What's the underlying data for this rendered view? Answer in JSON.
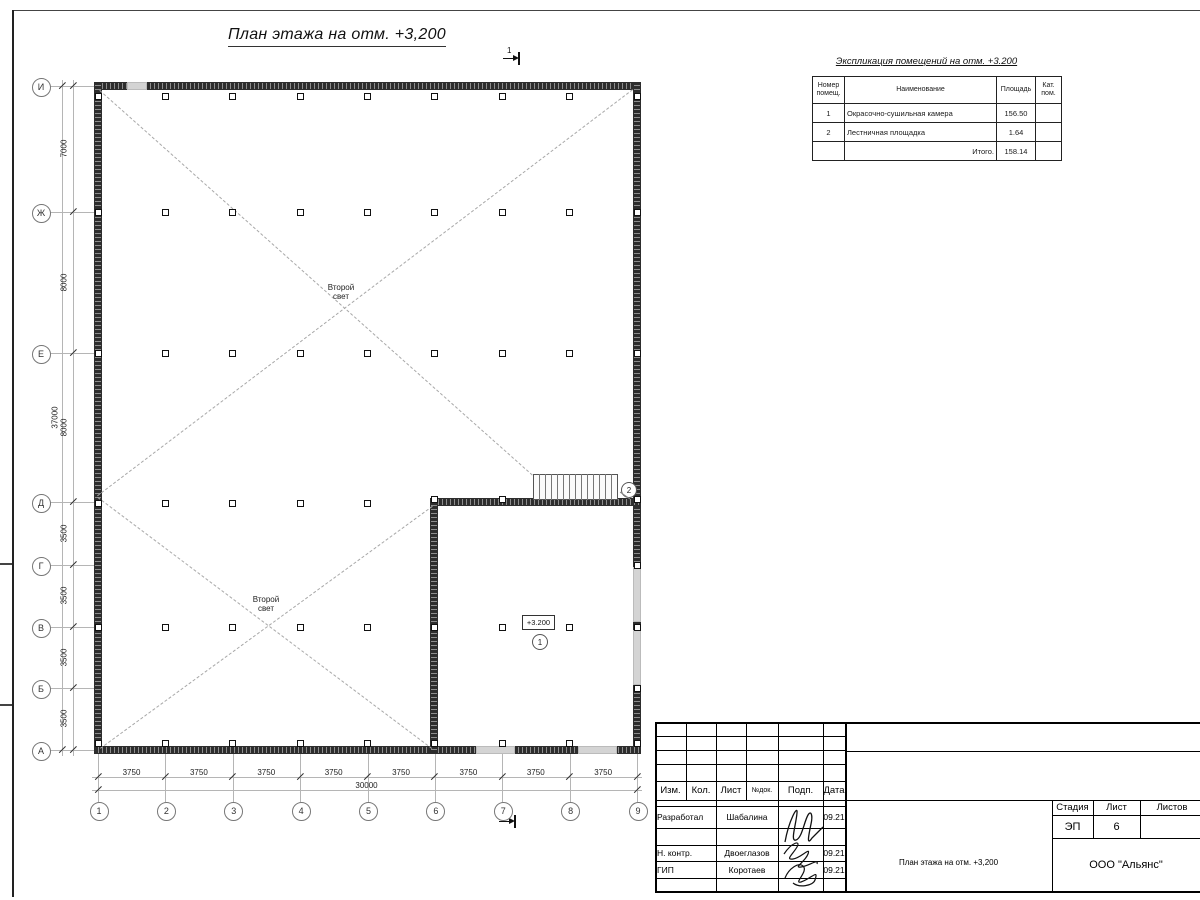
{
  "sheet": {
    "drawing_title": "План этажа на отм. +3,200",
    "section_mark": "1"
  },
  "plan": {
    "axis_letters": [
      "И",
      "Ж",
      "Е",
      "Д",
      "Г",
      "В",
      "Б",
      "А"
    ],
    "axis_numbers": [
      "1",
      "2",
      "3",
      "4",
      "5",
      "6",
      "7",
      "8",
      "9"
    ],
    "dims_left": [
      "7000",
      "8000",
      "8000",
      "3500",
      "3500",
      "3500",
      "3500"
    ],
    "dim_left_total": "37000",
    "dims_bottom": [
      "3750",
      "3750",
      "3750",
      "3750",
      "3750",
      "3750",
      "3750",
      "3750"
    ],
    "dim_bottom_total": "30000",
    "void_label": "Второй\nсвет",
    "elevation_tag": "+3.200",
    "room1_number": "1",
    "room2_number": "2"
  },
  "explication": {
    "title": "Экспликация помещений на отм. +3.200",
    "headers": {
      "number": "Номер помещ.",
      "name": "Наименование",
      "area": "Площадь",
      "category": "Кат. пом."
    },
    "rows": [
      {
        "number": "1",
        "name": "Окрасочно-сушильная камера",
        "area": "156.50",
        "category": ""
      },
      {
        "number": "2",
        "name": "Лестничная площадка",
        "area": "1.64",
        "category": ""
      }
    ],
    "total_label": "Итого.",
    "total_area": "158.14"
  },
  "titleblock": {
    "cols": {
      "izm": "Изм.",
      "kol": "Кол.",
      "list": "Лист",
      "ndoc": "№док.",
      "podp": "Подп.",
      "data": "Дата"
    },
    "people": [
      {
        "role": "Разработал",
        "name": "Шабалина",
        "date": "09.21"
      },
      {
        "role": "Н. контр.",
        "name": "Двоеглазов",
        "date": "09.21"
      },
      {
        "role": "ГИП",
        "name": "Коротаев",
        "date": "09.21"
      }
    ],
    "stage_label": "Стадия",
    "sheet_label": "Лист",
    "sheets_label": "Листов",
    "stage": "ЭП",
    "sheet_no": "6",
    "doc_name": "План этажа на отм. +3,200",
    "company": "ООО \"Альянс\""
  }
}
